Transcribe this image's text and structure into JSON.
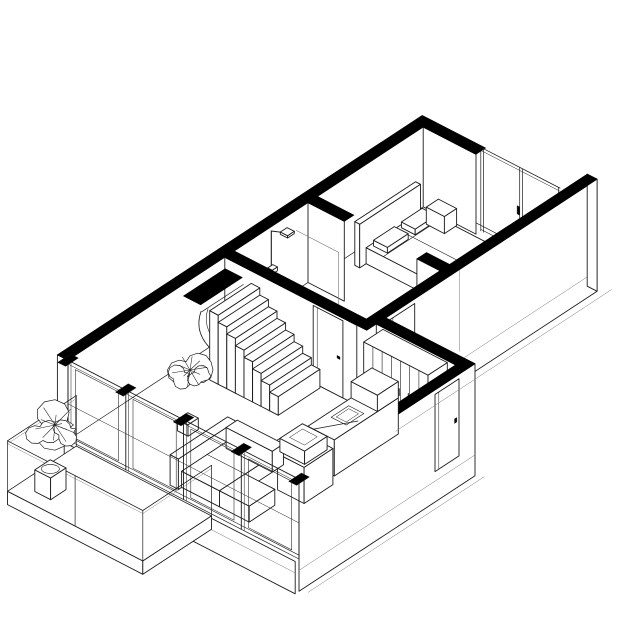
{
  "meta": {
    "kind": "architectural-axonometric-cutaway",
    "subject": "apartment interior isometric line drawing",
    "background": "#ffffff"
  },
  "colors": {
    "ink": "#1c1c1c",
    "paper": "#ffffff",
    "poche": "#000000",
    "light": "#777777"
  },
  "scene": {
    "rooms": [
      {
        "name": "bedroom"
      },
      {
        "name": "bathroom"
      },
      {
        "name": "living-room"
      },
      {
        "name": "kitchen"
      },
      {
        "name": "wardrobe-area"
      },
      {
        "name": "balcony"
      }
    ],
    "furniture": [
      "bed",
      "headboard-panel",
      "pillows",
      "bedside-table",
      "wardrobe",
      "modular-sofa",
      "coffee-table",
      "kitchen-island",
      "kitchen-counter",
      "staircase",
      "shower",
      "potted-plant-stairs",
      "potted-plant-balcony"
    ],
    "counts": {
      "wardrobe_panels": 7,
      "window_bays": 4,
      "stair_steps": 8,
      "glass_door_panels": 2,
      "doors": 4,
      "plants": 2
    },
    "view": {
      "projection": "isometric",
      "cut": "horizontal-section-cutaway",
      "cut_fill": "solid-black"
    }
  }
}
